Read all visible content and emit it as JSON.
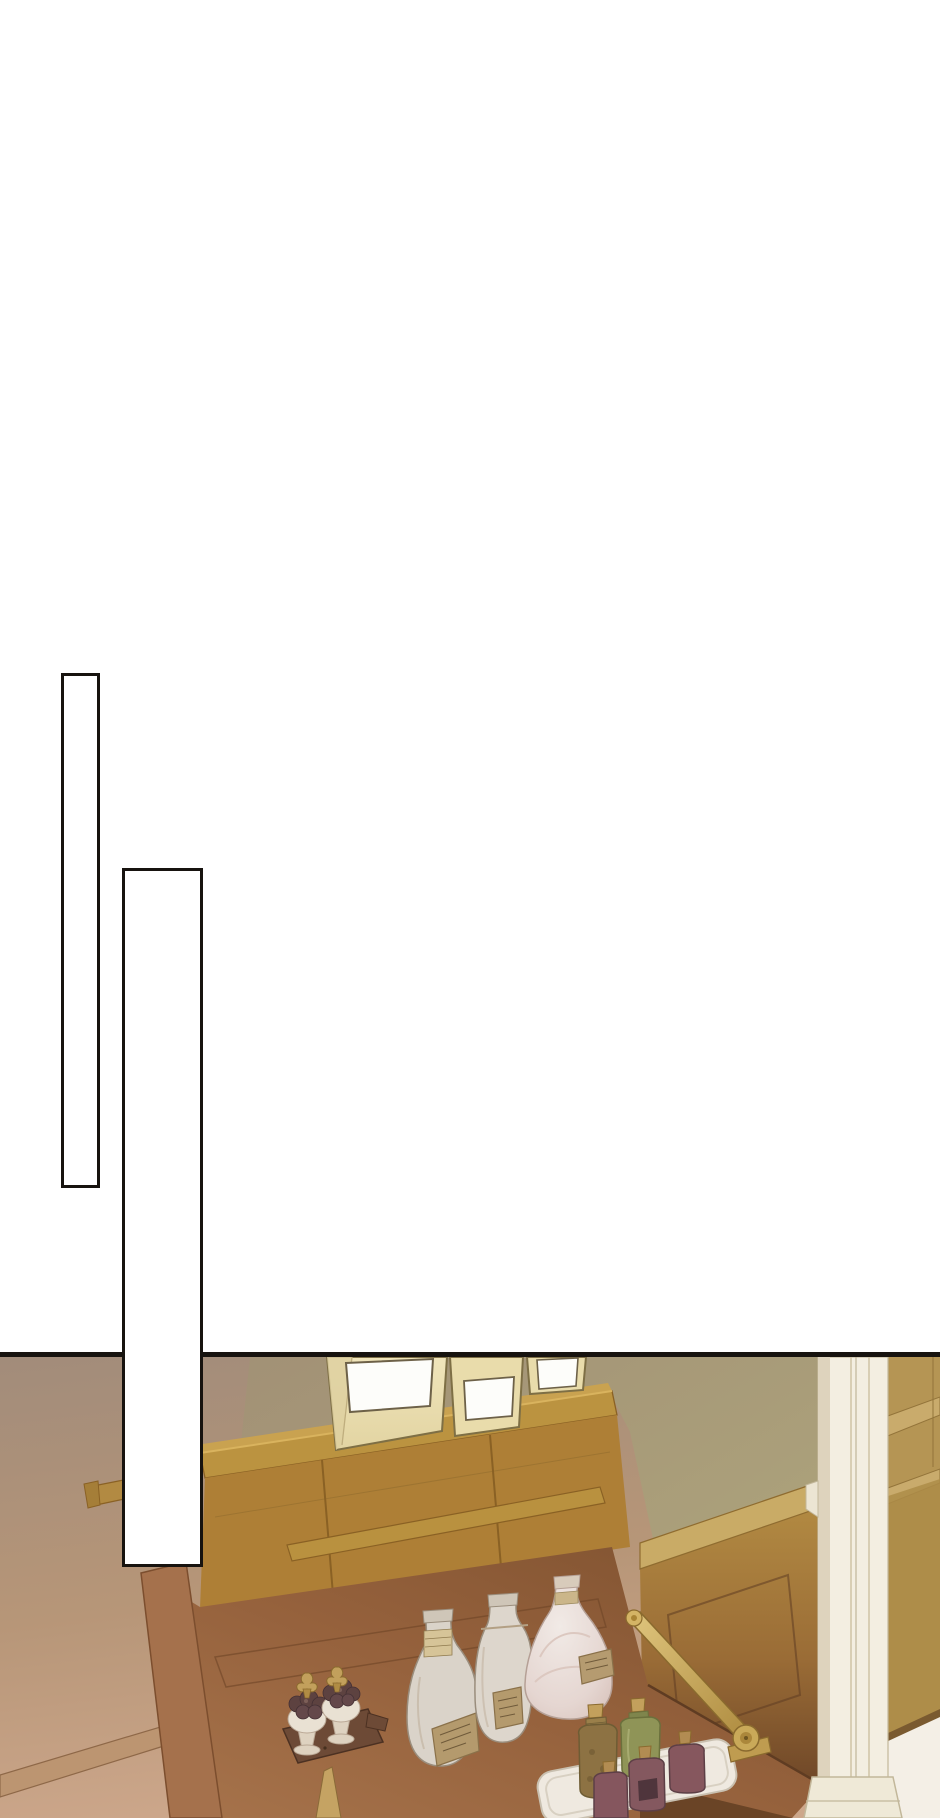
{
  "meta": {
    "kind": "webtoon-comic-panel",
    "canvas_width": 940,
    "canvas_height": 1818,
    "background": "#ffffff"
  },
  "speech_bubbles": [
    {
      "name": "vertical-speech-bubble-1",
      "text": "",
      "shape": "tall-empty-rectangle",
      "x": 61,
      "y": 673,
      "width": 39,
      "height": 515
    },
    {
      "name": "vertical-speech-bubble-2",
      "text": "",
      "shape": "tall-empty-rectangle",
      "x": 122,
      "y": 868,
      "width": 81,
      "height": 699
    }
  ],
  "panel": {
    "top": 1352,
    "height": 466,
    "border_color": "#17130f",
    "scene": "Warm sepia interior: an open secretary desk with cubby shelves, three paper bags with blank labels on the top shelf, apothecary bottles and jars on the writing surface, a brass lid-support arm, wood wainscot wall and a white door pillar at right",
    "objects": [
      {
        "name": "paper-bags",
        "count": 3,
        "label_text": ""
      },
      {
        "name": "hutch-shelf"
      },
      {
        "name": "wall-shelf"
      },
      {
        "name": "cubby-unit"
      },
      {
        "name": "desk-writing-surface"
      },
      {
        "name": "writing-quill"
      },
      {
        "name": "truffle-jars",
        "count": 2
      },
      {
        "name": "truffle-jar-tray"
      },
      {
        "name": "decanter-bottle",
        "label_text": ""
      },
      {
        "name": "tall-white-bottle",
        "label_text": ""
      },
      {
        "name": "pearl-flask",
        "label_text": ""
      },
      {
        "name": "serving-tray"
      },
      {
        "name": "amber-bottle"
      },
      {
        "name": "green-bottle"
      },
      {
        "name": "plum-bottles",
        "count": 3
      },
      {
        "name": "brass-support-arm"
      },
      {
        "name": "door-pillar"
      },
      {
        "name": "wainscot-wall"
      },
      {
        "name": "white-floor"
      }
    ]
  },
  "palette": {
    "paper": "#ffffff",
    "ink": "#17130f",
    "wall_left_top": "#a28c7a",
    "wall_left_bottom": "#cda78b",
    "wall_olive": "#a59874",
    "wood_shelf": "#bb9340",
    "wood_cubby": "#ae7f36",
    "wood_line": "#8a6124",
    "wainscot": "#b08840",
    "rail": "#c9ab66",
    "desk_top": "#96613c",
    "desk_edge": "#5f3c22",
    "desk_stile": "#a5714c",
    "pillar": "#f3eee1",
    "pillar_shadow": "#ded3bd",
    "pillar_line": "#c2b79a",
    "floor": "#f4efe6",
    "bag": "#ece0b2",
    "bag_outline": "#7e6f45",
    "label": "#fdfdfa",
    "bottle_white": "#dad3c9",
    "bottle_outline": "#9a8d7c",
    "bottle_label": "#b49a6d",
    "flask": "#e9dedb",
    "jar_white": "#e9e1d3",
    "truffle": "#5d4240",
    "gold": "#c2a05c",
    "gold_dark": "#8a6a2e",
    "brass": "#c9a959",
    "tray_dark": "#6d4a36",
    "tray_white": "#efe9e0",
    "amber": "#8d7243",
    "green": "#8f9457",
    "plum": "#85565e",
    "cork": "#c3a05c"
  }
}
